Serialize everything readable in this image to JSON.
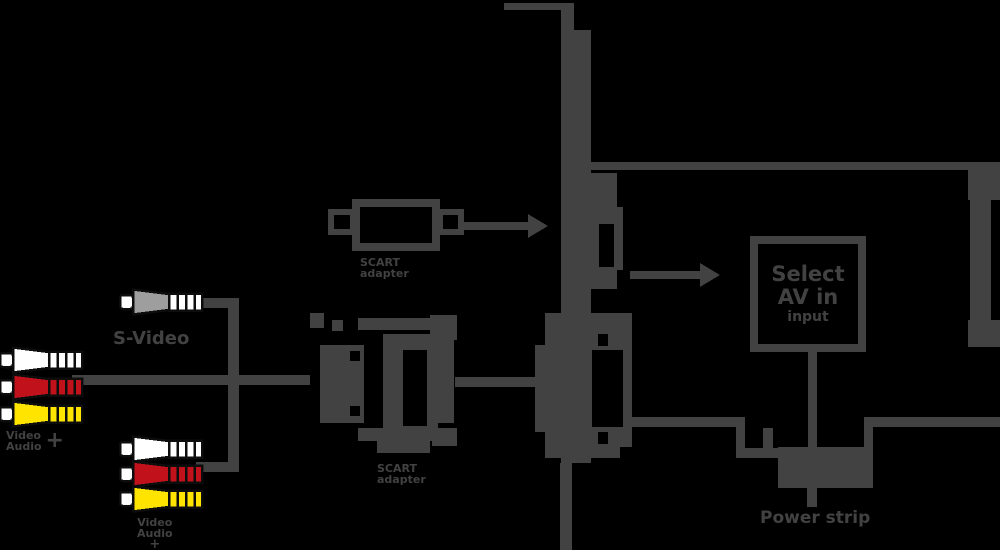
{
  "colors": {
    "background": "#000000",
    "line": "#424242",
    "plug_outline": "#0d0d0d",
    "white": "#ffffff",
    "red": "#c1121c",
    "yellow": "#ffe400",
    "gray_plug": "#9e9e9e"
  },
  "labels": {
    "source1": {
      "word1": "Video",
      "word2": "Audio",
      "plus": "+"
    },
    "svideo": "S-Video",
    "source2": {
      "word1": "Video",
      "word2": "Audio",
      "plus": "+"
    },
    "scart_side": {
      "line1": "SCART",
      "line2": "adapter"
    },
    "scart_front": {
      "line1": "SCART",
      "line2": "adapter"
    },
    "power": "Power strip"
  },
  "tv_display": {
    "line1": "Select",
    "line2": "AV in",
    "line3": "input"
  },
  "connectors": {
    "left_plug_group": [
      "white",
      "red",
      "yellow"
    ],
    "svideo_plug": "gray",
    "bottom_plug_group": [
      "white",
      "red",
      "yellow"
    ]
  }
}
